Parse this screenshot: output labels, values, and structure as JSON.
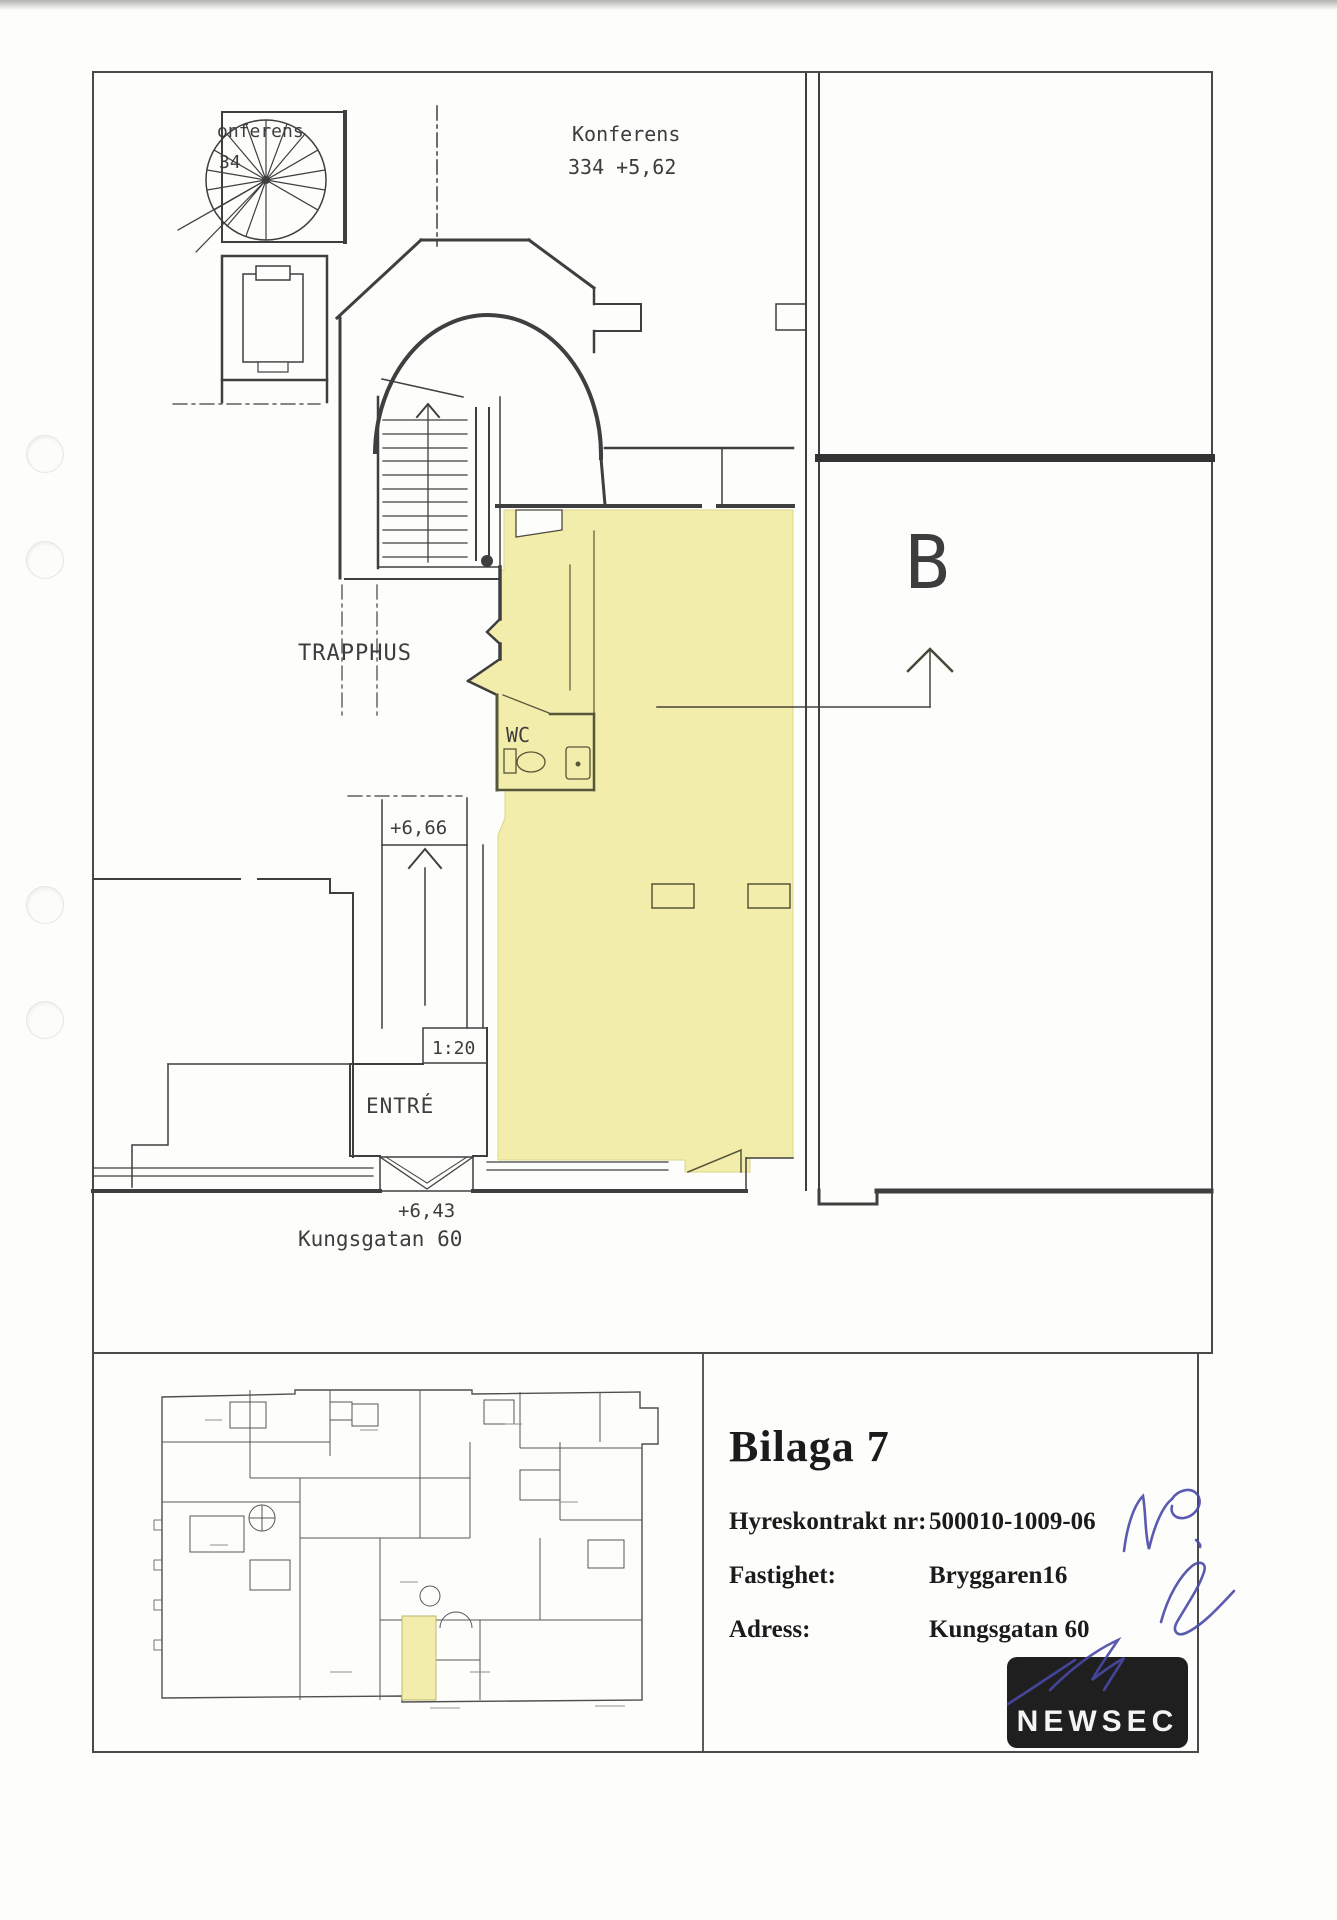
{
  "plan": {
    "labels": {
      "konferens_fragment_line1": "onferens",
      "konferens_fragment_line2": "34",
      "konferens_room": "Konferens",
      "konferens_room_info": "334 +5,62",
      "trapphus": "TRAPPHUS",
      "wc": "WC",
      "level_inner": "+6,66",
      "stair_ratio": "1:20",
      "entre": "ENTRÉ",
      "level_street": "+6,43",
      "street": "Kungsgatan 60",
      "section_marker": "B"
    },
    "highlight_color": "#f2edaa"
  },
  "title_block": {
    "title": "Bilaga 7",
    "fields": [
      {
        "label": "Hyreskontrakt nr:",
        "value": "500010-1009-06"
      },
      {
        "label": "Fastighet:",
        "value": "Bryggaren16"
      },
      {
        "label": "Adress:",
        "value": "Kungsgatan 60"
      }
    ],
    "handwriting": "MP.",
    "logo_text": "NEWSEC"
  }
}
